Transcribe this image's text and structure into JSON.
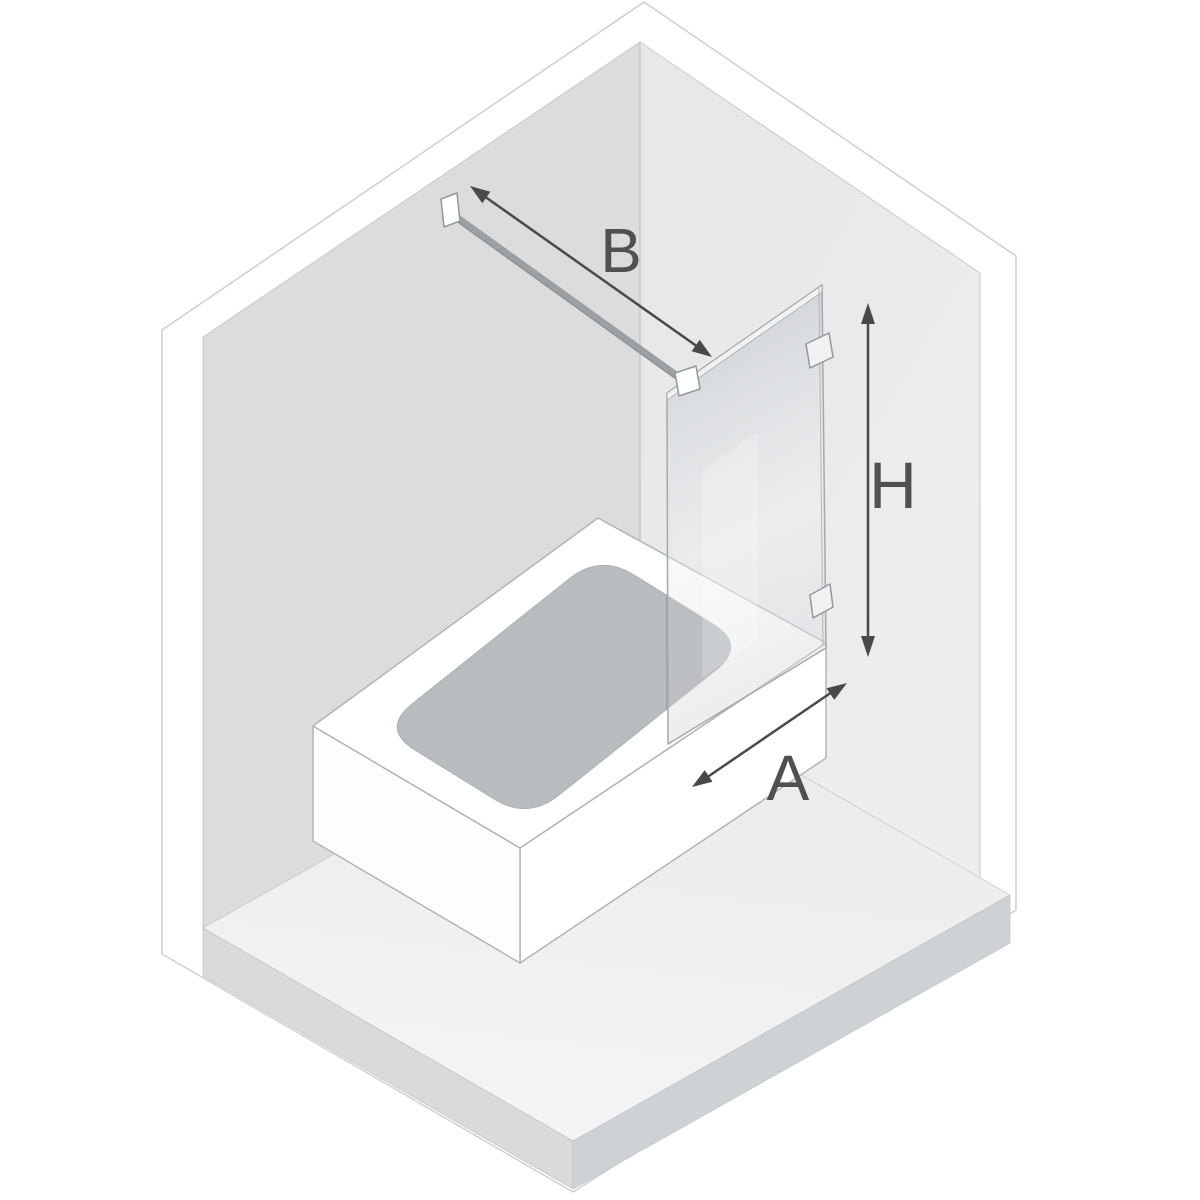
{
  "diagram": {
    "type": "isometric-bathtub-screen-installation-diagram",
    "labels": {
      "support_bar_length": "B",
      "panel_height": "H",
      "panel_width": "A"
    },
    "colors": {
      "background": "#ffffff",
      "dimension_arrow": "#48494b",
      "dimension_label": "#4e5052",
      "wall_left": "#dadcde",
      "wall_right": "#eaebed",
      "floor": "#eef0f1",
      "floor_edge_left": "#d8dadb",
      "floor_edge_right": "#cfd2d4",
      "tub": "#ffffff",
      "tub_outline": "#b2b5b7",
      "basin": "#b9bcbe",
      "basin_under_glass": "#a0a3a6",
      "glass_tint": "#d2d6d9",
      "glass_outline": "#a6a9ac",
      "hardware": "#9da0a3",
      "bracket_fill": "#f0f2f3"
    },
    "parts": [
      "left-wall",
      "right-wall",
      "floor",
      "floor-slab-edge",
      "bathtub",
      "basin",
      "glass-panel",
      "support-bar",
      "wall-bracket",
      "glass-bracket",
      "hinge-top",
      "hinge-bottom",
      "arrow-b",
      "arrow-h",
      "arrow-a"
    ]
  }
}
